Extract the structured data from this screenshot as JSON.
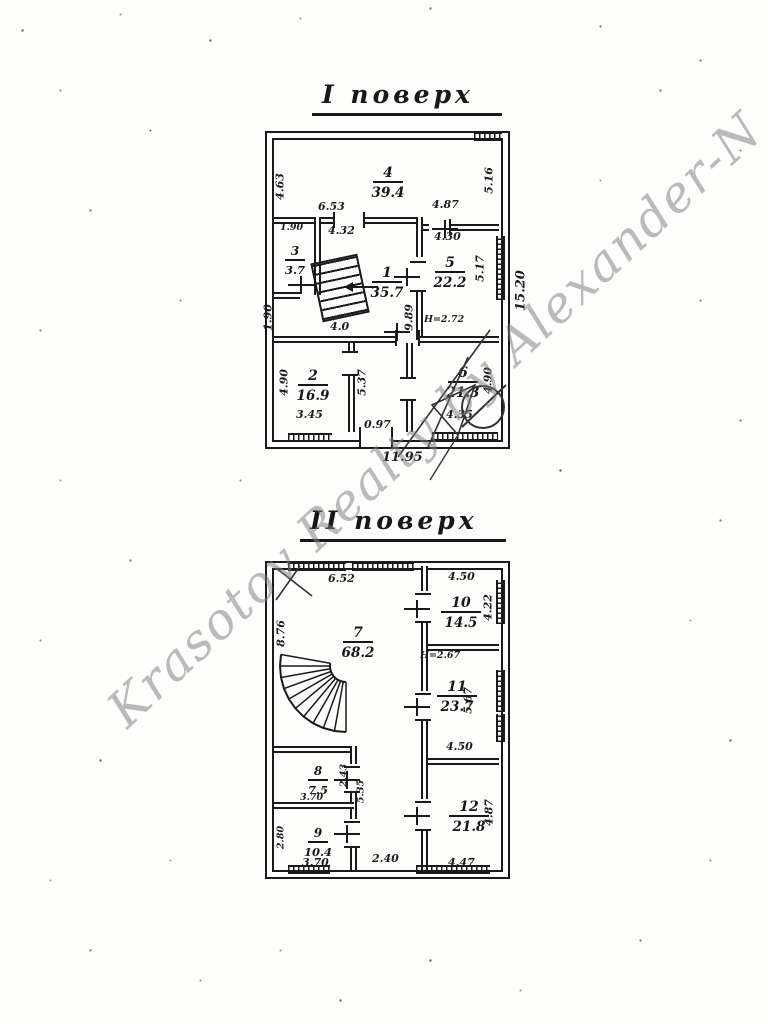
{
  "watermark": {
    "text": "Krasotov Realty by Alexander-N"
  },
  "floor1": {
    "title": "I поверх",
    "rooms": {
      "r4": {
        "num": "4",
        "area": "39.4"
      },
      "r3": {
        "num": "3",
        "area": "3.7"
      },
      "r1": {
        "num": "1",
        "area": "35.7"
      },
      "r5": {
        "num": "5",
        "area": "22.2"
      },
      "r2": {
        "num": "2",
        "area": "16.9"
      },
      "r6": {
        "num": "6",
        "area": "21.3"
      }
    },
    "dims": {
      "left_top": "4.63",
      "top_mid": "6.53",
      "door_mid": "4.32",
      "top_right": "4.87",
      "right_top": "5.16",
      "room5_top": "4.30",
      "room5_right": "5.17",
      "outer_right": "15.20",
      "room3_top": "1.90",
      "left_mid": "1.90",
      "room1_bottom": "4.0",
      "mid_right": "9.89",
      "height_note": "H=2.72",
      "room2_left": "4.90",
      "room2_bottom": "3.45",
      "hall_v": "5.37",
      "hall_door": "0.97",
      "room6_right": "4.90",
      "room6_bottom": "4.35",
      "bottom_overall": "11.95"
    }
  },
  "floor2": {
    "title": "II поверх",
    "rooms": {
      "r7": {
        "num": "7",
        "area": "68.2"
      },
      "r10": {
        "num": "10",
        "area": "14.5"
      },
      "r11": {
        "num": "11",
        "area": "23.7"
      },
      "r8": {
        "num": "8",
        "area": "7.5"
      },
      "r9": {
        "num": "9",
        "area": "10.4"
      },
      "r12": {
        "num": "12",
        "area": "21.8"
      }
    },
    "dims": {
      "top_left": "6.52",
      "room10_top": "4.50",
      "room10_right": "4.22",
      "left": "8.76",
      "height_note": "H=2.67",
      "room11_right": "5.67",
      "room11_bottom": "4.50",
      "room8_right_a": "2.43",
      "room8_right_b": "5.35",
      "room8_bottom": "3.70",
      "room9_left": "2.80",
      "room9_bottom": "3.70",
      "hall_bottom": "2.40",
      "room12_right": "4.87",
      "room12_bottom": "4.47"
    }
  }
}
